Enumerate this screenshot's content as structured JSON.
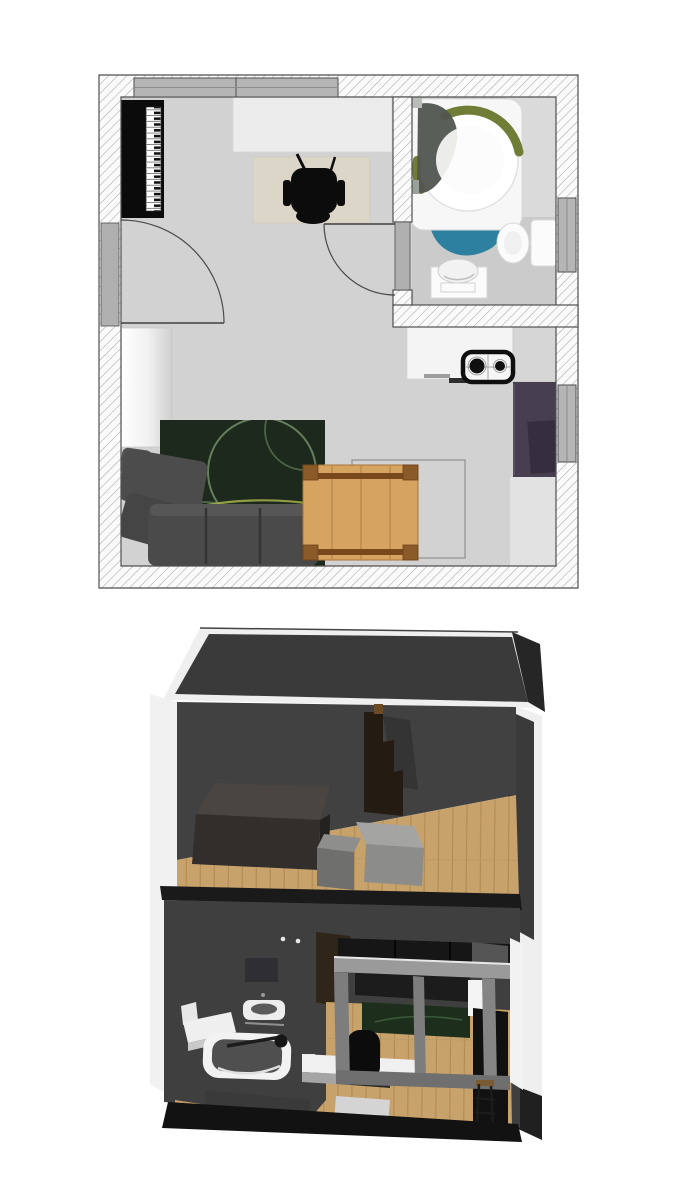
{
  "figures": {
    "floor_plan": {
      "type": "2d-floor-plan-top-view",
      "rooms": [
        "main-room",
        "bathroom",
        "kitchen-area"
      ],
      "furniture": [
        "piano",
        "desk",
        "office-chair",
        "desk-rug",
        "wardrobe",
        "area-rug",
        "corner-sofa",
        "dining-table",
        "dining-area-outline",
        "kitchen-counter",
        "cooktop",
        "armchair",
        "side-counter",
        "bathtub",
        "bath-mat",
        "toilet",
        "washbasin"
      ],
      "doors": [
        "entry-door",
        "bathroom-door"
      ],
      "windows": [
        "top-window",
        "bathroom-window",
        "living-room-window"
      ]
    },
    "render_3d": {
      "type": "3d-dollhouse-cutaway",
      "levels": [
        "upper-loft",
        "main-level"
      ],
      "upper_items": [
        "bed-box",
        "storage-box-small",
        "storage-box-large",
        "shelf-unit"
      ],
      "lower_items": [
        "bathroom-mirror",
        "washbasin-3d",
        "bathtub-3d",
        "side-table-3d",
        "sofa-3d",
        "area-rug-3d",
        "desk-3d",
        "office-chair-3d",
        "window-wall-frame",
        "tall-cabinet-3d",
        "bar-stool-3d",
        "heater-box-3d"
      ]
    }
  },
  "colors": {
    "plan-floor": "#d2d2d2",
    "bath-floor": "#cbcbcb",
    "wall-line": "#4f4f4f",
    "window-gray": "#b5b5b5",
    "door-gray": "#b0b0b0",
    "desk-top": "#ececec",
    "desk-rug": "#dcd6c8",
    "black": "#0c0c0c",
    "rug-green": "#1d291c",
    "rug-accent": "#7e9b74",
    "sofa-gray": "#4a4a4a",
    "wood-table": "#d7a361",
    "wood-trim": "#82521f",
    "counter-white": "#f4f4f4",
    "side-counter": "#d6d6d6",
    "armchair-plum": "#473f4f",
    "mat-blue": "#2e80a0",
    "tub-olive": "#6f7d36",
    "tub-gray": "#51554f",
    "fixture-white": "#fbfbfb",
    "wall3d": "#3f3f3f",
    "roof3d": "#3a3a3a",
    "edge-white": "#efefef",
    "wood-floor": "#c8a26b",
    "wood-line": "#b08b52",
    "slab-dark": "#1a1a1a",
    "box-brown-top": "#4b4541",
    "box-brown": "#322e2b",
    "box-gray": "#9e9e9c",
    "shelf-brown": "#241b13",
    "sofa3d": "#161616",
    "rug3d": "#1e2e1d",
    "frame-gray": "#8a8a8a",
    "door3d-brown": "#2f2619"
  }
}
